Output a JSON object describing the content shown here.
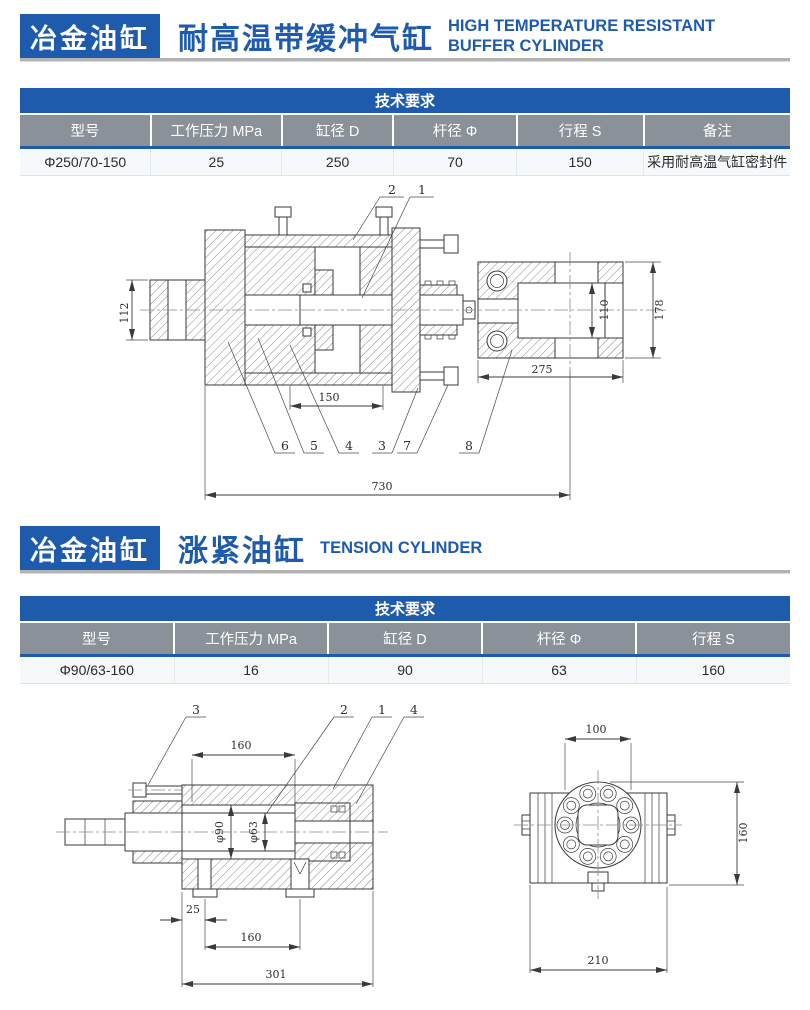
{
  "colors": {
    "brand_blue": "#1f5bad",
    "header_gray": "#8b9198",
    "row_bg": "#f6f9fc",
    "rule_gray": "#b3b3b3"
  },
  "section1": {
    "brand": "冶金油缸",
    "title_zh": "耐高温带缓冲气缸",
    "title_en": "HIGH TEMPERATURE RESISTANT BUFFER CYLINDER",
    "table": {
      "title": "技术要求",
      "columns": [
        "型号",
        "工作压力 MPa",
        "缸径 D",
        "杆径 Φ",
        "行程 S",
        "备注"
      ],
      "row": [
        "Φ250/70-150",
        "25",
        "250",
        "70",
        "150",
        "采用耐高温气缸密封件"
      ]
    },
    "drawing": {
      "callouts": {
        "n1": "1",
        "n2": "2",
        "n3": "3",
        "n4": "4",
        "n5": "5",
        "n6": "6",
        "n7": "7",
        "n8": "8"
      },
      "dims": {
        "d112": "112",
        "d150": "150",
        "d110": "110",
        "d178": "178",
        "d275": "275",
        "d730": "730"
      }
    }
  },
  "section2": {
    "brand": "冶金油缸",
    "title_zh": "涨紧油缸",
    "title_en": "TENSION CYLINDER",
    "table": {
      "title": "技术要求",
      "columns": [
        "型号",
        "工作压力 MPa",
        "缸径 D",
        "杆径 Φ",
        "行程 S"
      ],
      "row": [
        "Φ90/63-160",
        "16",
        "90",
        "63",
        "160"
      ]
    },
    "drawing_section": {
      "callouts": {
        "n1": "1",
        "n2": "2",
        "n3": "3",
        "n4": "4"
      },
      "dims": {
        "top": "160",
        "bore": "φ90",
        "rod": "φ63",
        "offset": "25",
        "mid": "160",
        "total": "301"
      }
    },
    "drawing_end": {
      "dims": {
        "top": "100",
        "side": "160",
        "bottom": "210"
      }
    }
  }
}
